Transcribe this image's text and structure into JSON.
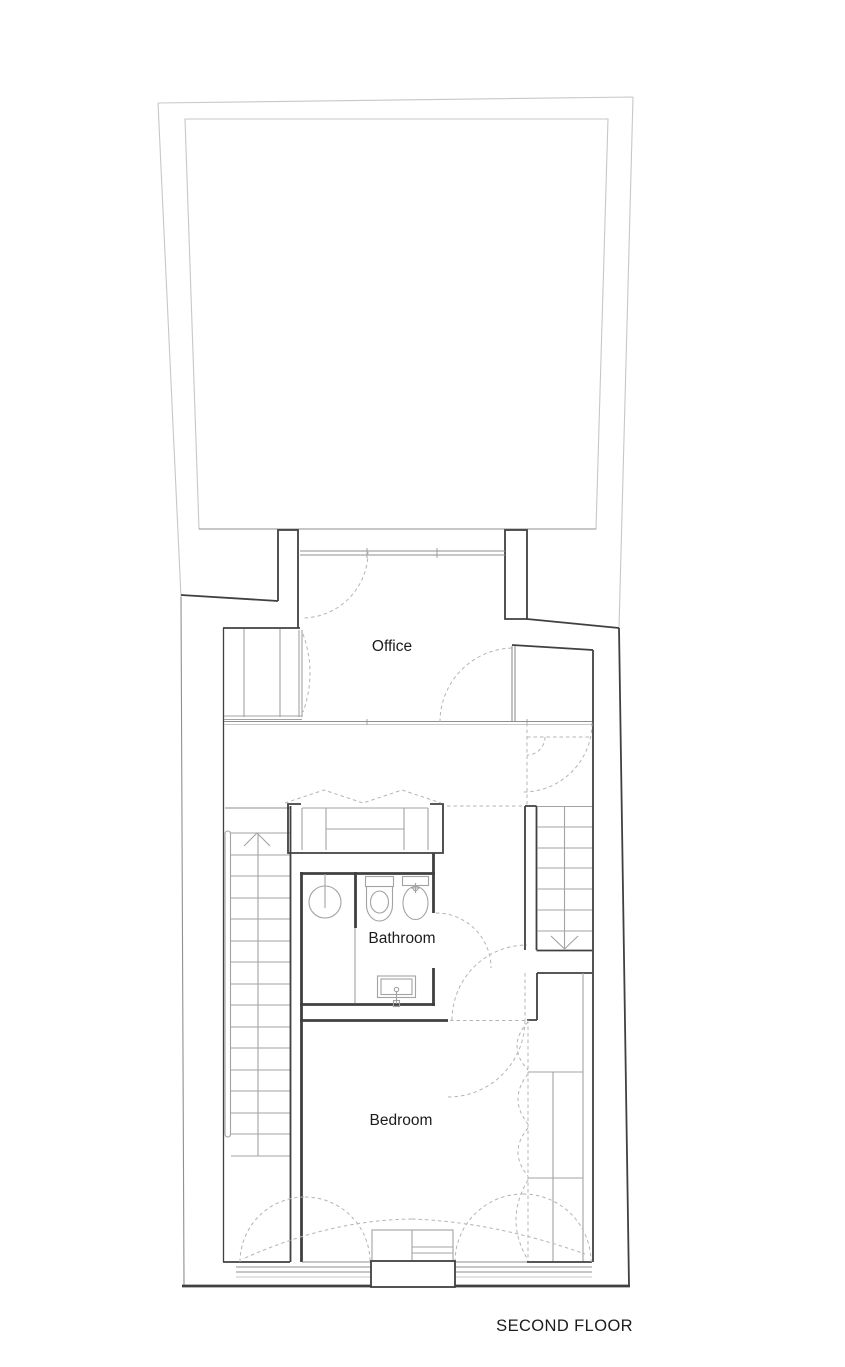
{
  "plan": {
    "floor_label": "SECOND FLOOR",
    "rooms": [
      {
        "id": "office",
        "label": "Office"
      },
      {
        "id": "bathroom",
        "label": "Bathroom"
      },
      {
        "id": "bedroom",
        "label": "Bedroom"
      }
    ],
    "fixtures": [
      "roof-terrace",
      "entry-door",
      "office-closet",
      "hall-closet",
      "wardrobe",
      "shower",
      "toilet",
      "bidet",
      "washbasin",
      "staircase-up",
      "staircase-down",
      "bedroom-closets",
      "window-cabinet",
      "bay-window-box"
    ]
  },
  "colors": {
    "wall": "#404040",
    "wall_medium": "#8f8f8f",
    "furniture": "#a3a3a3",
    "terrace": "#c7c7c7",
    "dashed": "#b4b4b4",
    "text": "#1c1c1c",
    "background": "#ffffff"
  }
}
